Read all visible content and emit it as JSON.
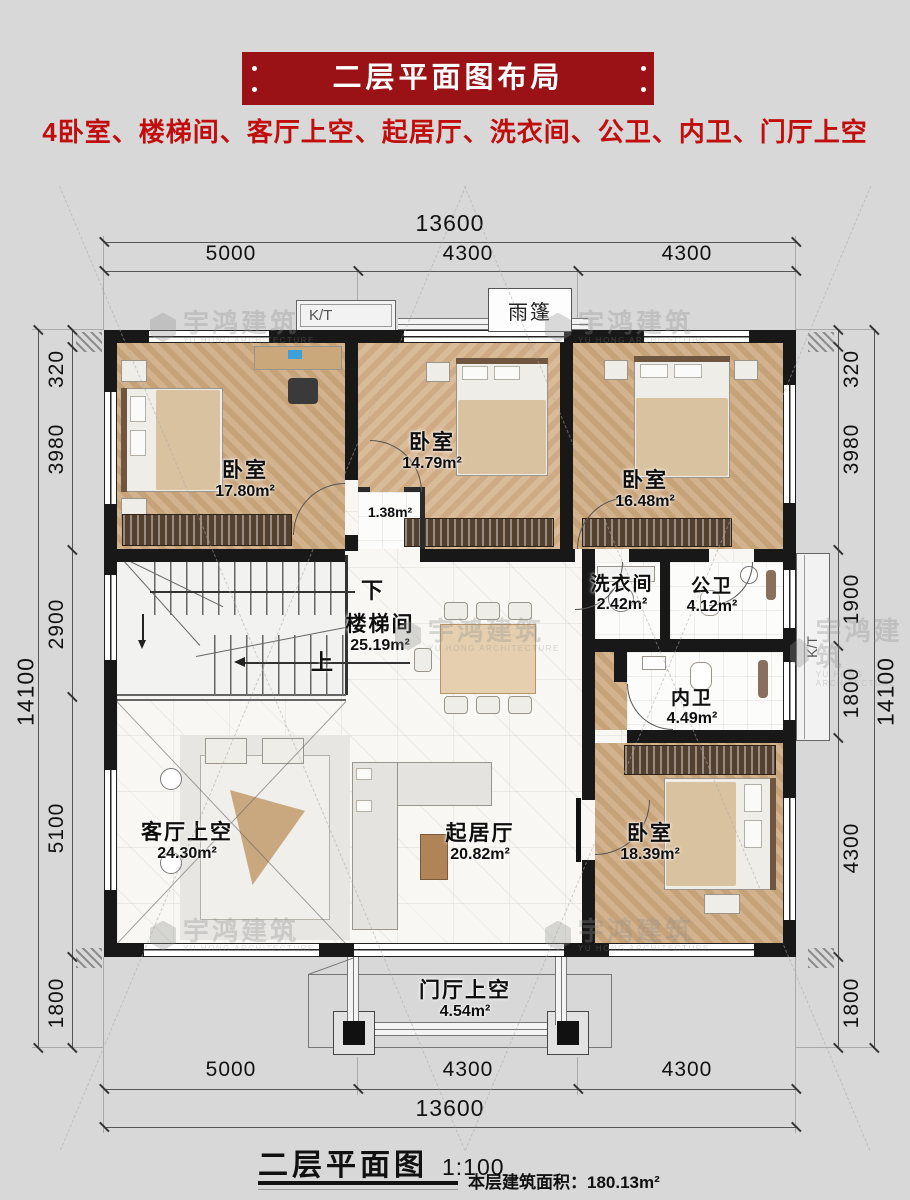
{
  "header": {
    "banner_title": "二层平面图布局",
    "subtitle": "4卧室、楼梯间、客厅上空、起居厅、洗衣间、公卫、内卫、门厅上空"
  },
  "plan": {
    "rooms": [
      {
        "id": "bedroom-1",
        "name": "卧室",
        "area": "17.80m²"
      },
      {
        "id": "bedroom-2",
        "name": "卧室",
        "area": "14.79m²"
      },
      {
        "id": "bedroom-3",
        "name": "卧室",
        "area": "16.48m²"
      },
      {
        "id": "vestibule",
        "name": "",
        "area": "1.38m²"
      },
      {
        "id": "stairwell",
        "name": "楼梯间",
        "area": "25.19m²"
      },
      {
        "id": "laundry",
        "name": "洗衣间",
        "area": "2.42m²"
      },
      {
        "id": "public-bath",
        "name": "公卫",
        "area": "4.12m²"
      },
      {
        "id": "private-bath",
        "name": "内卫",
        "area": "4.49m²"
      },
      {
        "id": "living-void",
        "name": "客厅上空",
        "area": "24.30m²"
      },
      {
        "id": "sitting-room",
        "name": "起居厅",
        "area": "20.82m²"
      },
      {
        "id": "bedroom-4",
        "name": "卧室",
        "area": "18.39m²"
      },
      {
        "id": "foyer-void",
        "name": "门厅上空",
        "area": "4.54m²"
      }
    ],
    "annotations": {
      "canopy": "雨篷",
      "kt": "K/T",
      "stairs_down": "下",
      "stairs_up": "上"
    },
    "dims": {
      "top": {
        "total": "13600",
        "segments": [
          "5000",
          "4300",
          "4300"
        ]
      },
      "bottom": {
        "total": "13600",
        "segments": [
          "5000",
          "4300",
          "4300"
        ]
      },
      "left": {
        "total": "14100",
        "segments": [
          "320",
          "3980",
          "2900",
          "5100",
          "1800"
        ]
      },
      "right": {
        "total": "14100",
        "segments": [
          "320",
          "3980",
          "1900",
          "1800",
          "4300",
          "1800"
        ]
      }
    }
  },
  "footer": {
    "title": "二层平面图",
    "scale": "1:100",
    "area_note": "本层建筑面积：180.13m²"
  },
  "watermark": {
    "cn": "宇鸿建筑",
    "en": "YU HONG ARCHITECTURE"
  },
  "colors": {
    "banner_bg": "#9b1216",
    "subtitle_red": "#c20d0d",
    "wall": "#181818",
    "wood": "#cda87d"
  }
}
